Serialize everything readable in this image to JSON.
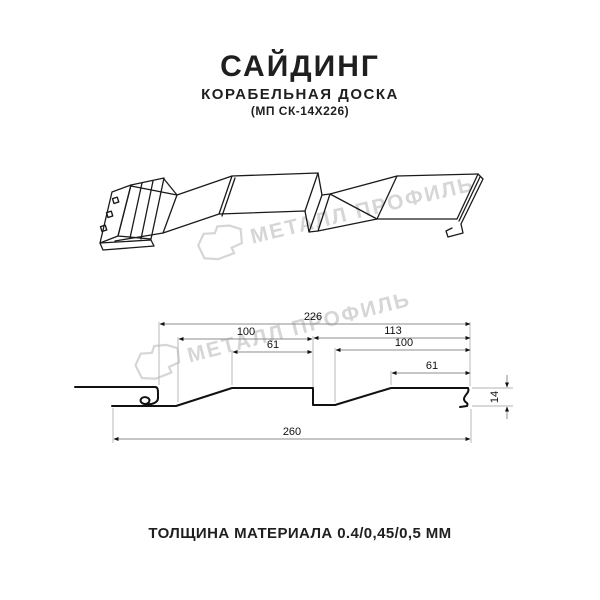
{
  "header": {
    "title": "САЙДИНГ",
    "subtitle": "КОРАБЕЛЬНАЯ ДОСКА",
    "code": "(МП СК-14Х226)"
  },
  "watermark": {
    "brand": "МЕТАЛЛ ПРОФИЛЬ",
    "color": "#d6d6d6"
  },
  "section_drawing": {
    "dimensions": {
      "overall_module": "226",
      "left_panel": "100",
      "right_span": "113",
      "left_flat": "61",
      "right_panel": "100",
      "right_flat": "61",
      "total_width": "260",
      "profile_height": "14"
    },
    "units": "mm"
  },
  "footer": {
    "thickness_note": "ТОЛЩИНА МАТЕРИАЛА 0.4/0,45/0,5 ММ"
  },
  "colors": {
    "line": "#1a1a1a",
    "dim_line": "#8c8c8c",
    "extension_line": "#b3b3b3"
  }
}
